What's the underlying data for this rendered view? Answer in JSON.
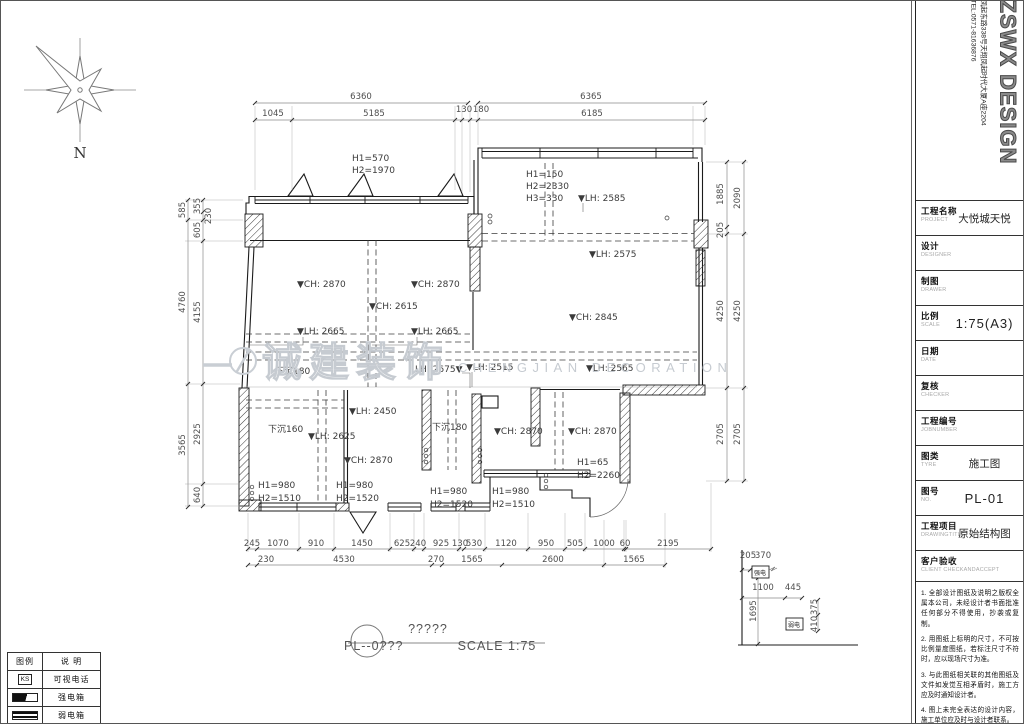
{
  "drawing": {
    "watermark_cn": "诚建装饰",
    "watermark_en": "CHENGJIAN DECORATION",
    "texts": [
      {
        "t": "6360",
        "x": 361,
        "y": 99
      },
      {
        "t": "6365",
        "x": 591,
        "y": 99
      },
      {
        "t": "1045",
        "x": 273,
        "y": 116
      },
      {
        "t": "5185",
        "x": 374,
        "y": 116
      },
      {
        "t": "130",
        "x": 464,
        "y": 112
      },
      {
        "t": "180",
        "x": 481,
        "y": 112
      },
      {
        "t": "6185",
        "x": 592,
        "y": 116
      },
      {
        "t": "585",
        "x": 185,
        "y": 210,
        "r": 1
      },
      {
        "t": "4760",
        "x": 185,
        "y": 302,
        "r": 1
      },
      {
        "t": "3565",
        "x": 185,
        "y": 445,
        "r": 1
      },
      {
        "t": "355",
        "x": 200,
        "y": 206,
        "r": 1
      },
      {
        "t": "230",
        "x": 211,
        "y": 216,
        "r": 1
      },
      {
        "t": "605",
        "x": 200,
        "y": 230,
        "r": 1
      },
      {
        "t": "4155",
        "x": 200,
        "y": 312,
        "r": 1
      },
      {
        "t": "2925",
        "x": 200,
        "y": 434,
        "r": 1
      },
      {
        "t": "640",
        "x": 200,
        "y": 495,
        "r": 1
      },
      {
        "t": "1885",
        "x": 723,
        "y": 194,
        "r": 1
      },
      {
        "t": "205",
        "x": 723,
        "y": 230,
        "r": 1
      },
      {
        "t": "4250",
        "x": 723,
        "y": 311,
        "r": 1
      },
      {
        "t": "2705",
        "x": 723,
        "y": 434,
        "r": 1
      },
      {
        "t": "2090",
        "x": 740,
        "y": 198,
        "r": 1
      },
      {
        "t": "4250",
        "x": 740,
        "y": 311,
        "r": 1
      },
      {
        "t": "2705",
        "x": 740,
        "y": 434,
        "r": 1
      },
      {
        "t": "245",
        "x": 252,
        "y": 546
      },
      {
        "t": "1070",
        "x": 278,
        "y": 546
      },
      {
        "t": "910",
        "x": 316,
        "y": 546
      },
      {
        "t": "1450",
        "x": 362,
        "y": 546
      },
      {
        "t": "625",
        "x": 402,
        "y": 546
      },
      {
        "t": "240",
        "x": 418,
        "y": 546
      },
      {
        "t": "925",
        "x": 441,
        "y": 546
      },
      {
        "t": "130",
        "x": 460,
        "y": 546
      },
      {
        "t": "530",
        "x": 474,
        "y": 546
      },
      {
        "t": "1120",
        "x": 506,
        "y": 546
      },
      {
        "t": "950",
        "x": 546,
        "y": 546
      },
      {
        "t": "505",
        "x": 575,
        "y": 546
      },
      {
        "t": "1000",
        "x": 604,
        "y": 546
      },
      {
        "t": "60",
        "x": 625,
        "y": 546
      },
      {
        "t": "2195",
        "x": 668,
        "y": 546
      },
      {
        "t": "230",
        "x": 266,
        "y": 562
      },
      {
        "t": "4530",
        "x": 344,
        "y": 562
      },
      {
        "t": "270",
        "x": 436,
        "y": 562
      },
      {
        "t": "1565",
        "x": 472,
        "y": 562
      },
      {
        "t": "2600",
        "x": 553,
        "y": 562
      },
      {
        "t": "1565",
        "x": 634,
        "y": 562
      },
      {
        "t": "205",
        "x": 748,
        "y": 558
      },
      {
        "t": "370",
        "x": 763,
        "y": 558
      },
      {
        "t": "1100",
        "x": 763,
        "y": 590
      },
      {
        "t": "445",
        "x": 793,
        "y": 590
      },
      {
        "t": "1695",
        "x": 756,
        "y": 611,
        "r": 1
      },
      {
        "t": "375",
        "x": 817,
        "y": 607,
        "r": 1
      },
      {
        "t": "410",
        "x": 817,
        "y": 624,
        "r": 1
      },
      {
        "t": "H1=570",
        "x": 352,
        "y": 161,
        "c": "note",
        "a": "s"
      },
      {
        "t": "H2=1970",
        "x": 352,
        "y": 173,
        "c": "note",
        "a": "s"
      },
      {
        "t": "H1=150",
        "x": 526,
        "y": 177,
        "c": "note",
        "a": "s"
      },
      {
        "t": "H2=2330",
        "x": 526,
        "y": 189,
        "c": "note",
        "a": "s"
      },
      {
        "t": "H3=330",
        "x": 526,
        "y": 201,
        "c": "note",
        "a": "s"
      },
      {
        "t": "▼LH: 2585",
        "x": 578,
        "y": 201,
        "c": "note",
        "a": "s"
      },
      {
        "t": "▼LH: 2575",
        "x": 589,
        "y": 257,
        "c": "note",
        "a": "s"
      },
      {
        "t": "▼CH: 2870",
        "x": 297,
        "y": 287,
        "c": "note",
        "a": "s"
      },
      {
        "t": "▼CH: 2870",
        "x": 411,
        "y": 287,
        "c": "note",
        "a": "s"
      },
      {
        "t": "▼CH: 2615",
        "x": 369,
        "y": 309,
        "c": "note",
        "a": "s"
      },
      {
        "t": "▼LH: 2665",
        "x": 297,
        "y": 334,
        "c": "note",
        "a": "s"
      },
      {
        "t": "▼LH: 2665",
        "x": 411,
        "y": 334,
        "c": "note",
        "a": "s"
      },
      {
        "t": "▼CH: 2845",
        "x": 569,
        "y": 320,
        "c": "note",
        "a": "s"
      },
      {
        "t": "下沉180",
        "x": 275,
        "y": 374,
        "c": "note",
        "a": "s"
      },
      {
        "t": "LH: 2675▼",
        "x": 415,
        "y": 372,
        "c": "note",
        "a": "s"
      },
      {
        "t": "▼LH: 2515",
        "x": 466,
        "y": 370,
        "c": "note",
        "a": "s"
      },
      {
        "t": "▼LH: 2565",
        "x": 586,
        "y": 371,
        "c": "note",
        "a": "s"
      },
      {
        "t": "▼LH: 2450",
        "x": 349,
        "y": 414,
        "c": "note",
        "a": "s"
      },
      {
        "t": "下沉160",
        "x": 268,
        "y": 432,
        "c": "note",
        "a": "s"
      },
      {
        "t": "▼LH: 2625",
        "x": 308,
        "y": 439,
        "c": "note",
        "a": "s"
      },
      {
        "t": "▼CH: 2870",
        "x": 344,
        "y": 463,
        "c": "note",
        "a": "s"
      },
      {
        "t": "下沉180",
        "x": 432,
        "y": 430,
        "c": "note",
        "a": "s"
      },
      {
        "t": "▼CH: 2870",
        "x": 494,
        "y": 434,
        "c": "note",
        "a": "s"
      },
      {
        "t": "▼CH: 2870",
        "x": 568,
        "y": 434,
        "c": "note",
        "a": "s"
      },
      {
        "t": "H1=65",
        "x": 577,
        "y": 465,
        "c": "note",
        "a": "s"
      },
      {
        "t": "H2=2260",
        "x": 577,
        "y": 478,
        "c": "note",
        "a": "s"
      },
      {
        "t": "H1=980",
        "x": 258,
        "y": 488,
        "c": "note",
        "a": "s"
      },
      {
        "t": "H2=1510",
        "x": 258,
        "y": 501,
        "c": "note",
        "a": "s"
      },
      {
        "t": "H1=980",
        "x": 336,
        "y": 488,
        "c": "note",
        "a": "s"
      },
      {
        "t": "H2=1520",
        "x": 336,
        "y": 501,
        "c": "note",
        "a": "s"
      },
      {
        "t": "H1=980",
        "x": 430,
        "y": 494,
        "c": "note",
        "a": "s"
      },
      {
        "t": "H2=1520",
        "x": 430,
        "y": 507,
        "c": "note",
        "a": "s"
      },
      {
        "t": "H1=980",
        "x": 492,
        "y": 494,
        "c": "note",
        "a": "s"
      },
      {
        "t": "H2=1510",
        "x": 492,
        "y": 507,
        "c": "note",
        "a": "s"
      },
      {
        "t": "强电",
        "x": 760,
        "y": 575,
        "c": "box"
      },
      {
        "t": "弱电",
        "x": 794,
        "y": 627,
        "c": "box"
      },
      {
        "t": "诚建装饰",
        "x": 262,
        "y": 376,
        "c": "wmcn",
        "a": "s"
      },
      {
        "t": "CHENGJIAN DECORATION",
        "x": 458,
        "y": 372,
        "c": "wmen",
        "a": "s"
      },
      {
        "t": "?????",
        "x": 428,
        "y": 633,
        "c": "title"
      },
      {
        "t": "PL--0???",
        "x": 344,
        "y": 650,
        "c": "title",
        "a": "s"
      },
      {
        "t": "SCALE  1:75",
        "x": 497,
        "y": 650,
        "c": "title"
      },
      {
        "t": "N",
        "x": 80,
        "y": 158,
        "c": "north"
      }
    ]
  },
  "legend": {
    "col_headers": [
      "图例",
      "说 明"
    ],
    "rows": [
      {
        "symbol": "ks",
        "symbol_text": "KS",
        "label": "可视电话"
      },
      {
        "symbol": "strong",
        "label": "强电箱"
      },
      {
        "symbol": "weak",
        "label": "弱电箱"
      }
    ]
  },
  "title_block": {
    "logo_text": "ZSWX DESIGN",
    "address": "凤起东路338号天翔凤起时代大厦A座2204",
    "tel": "TEL:0571-81636876",
    "fields": [
      {
        "label": "工程名称",
        "sub": "PROJECT",
        "value": "大悦城天悦"
      },
      {
        "label": "设计",
        "sub": "DESIGNER",
        "value": ""
      },
      {
        "label": "制图",
        "sub": "DRAWER",
        "value": ""
      },
      {
        "label": "比例",
        "sub": "SCALE",
        "value": "1:75(A3)",
        "vclass": "lg"
      },
      {
        "label": "日期",
        "sub": "DATE",
        "value": ""
      },
      {
        "label": "复核",
        "sub": "CHECKER",
        "value": ""
      },
      {
        "label": "工程编号",
        "sub": "JOBNUMBER",
        "value": ""
      },
      {
        "label": "图类",
        "sub": "TYRE",
        "value": "施工图"
      },
      {
        "label": "图号",
        "sub": "NO.",
        "value": "PL-01",
        "vclass": "lg"
      },
      {
        "label": "工程项目",
        "sub": "DRAWINGTITLE",
        "value": "原始结构图"
      },
      {
        "label": "客户验收",
        "sub": "CLIENT CHECKANDACCEPT",
        "value": "",
        "tall": true
      }
    ],
    "notes": [
      "1. 全部设计图纸及说明之版权全属本公司，未经设计者书面批准任何部分不得使用，抄袭或复制。",
      "2. 用图纸上标明的尺寸，不可按比例量度图纸，若标注尺寸不符时，应以现场尺寸为准。",
      "3. 与此图纸相关联的其他图纸及文件如发觉互相矛盾时，施工方应及时通知设计者。",
      "4. 图上未完全表达的设计内容，施工单位应及时与设计者联系。"
    ]
  }
}
